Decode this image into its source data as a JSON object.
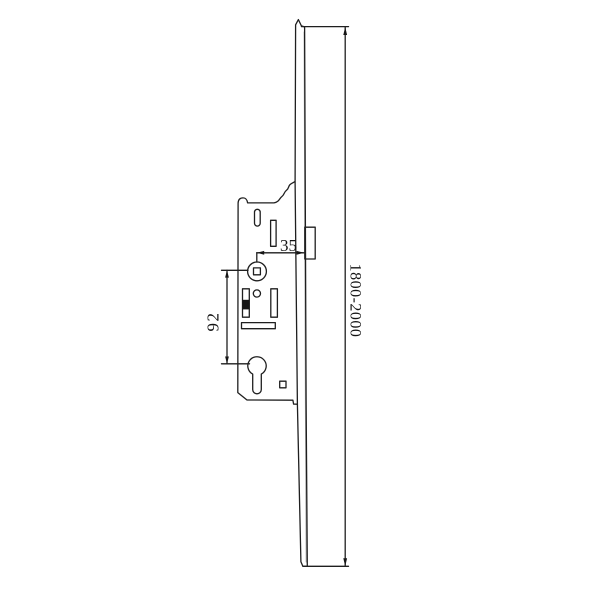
{
  "drawing": {
    "background": "#ffffff",
    "line_color": "#1f1f1f",
    "dim_backset": {
      "label": "35"
    },
    "dim_centers": {
      "label": "92"
    },
    "dim_length": {
      "label": "1800-2000"
    }
  }
}
